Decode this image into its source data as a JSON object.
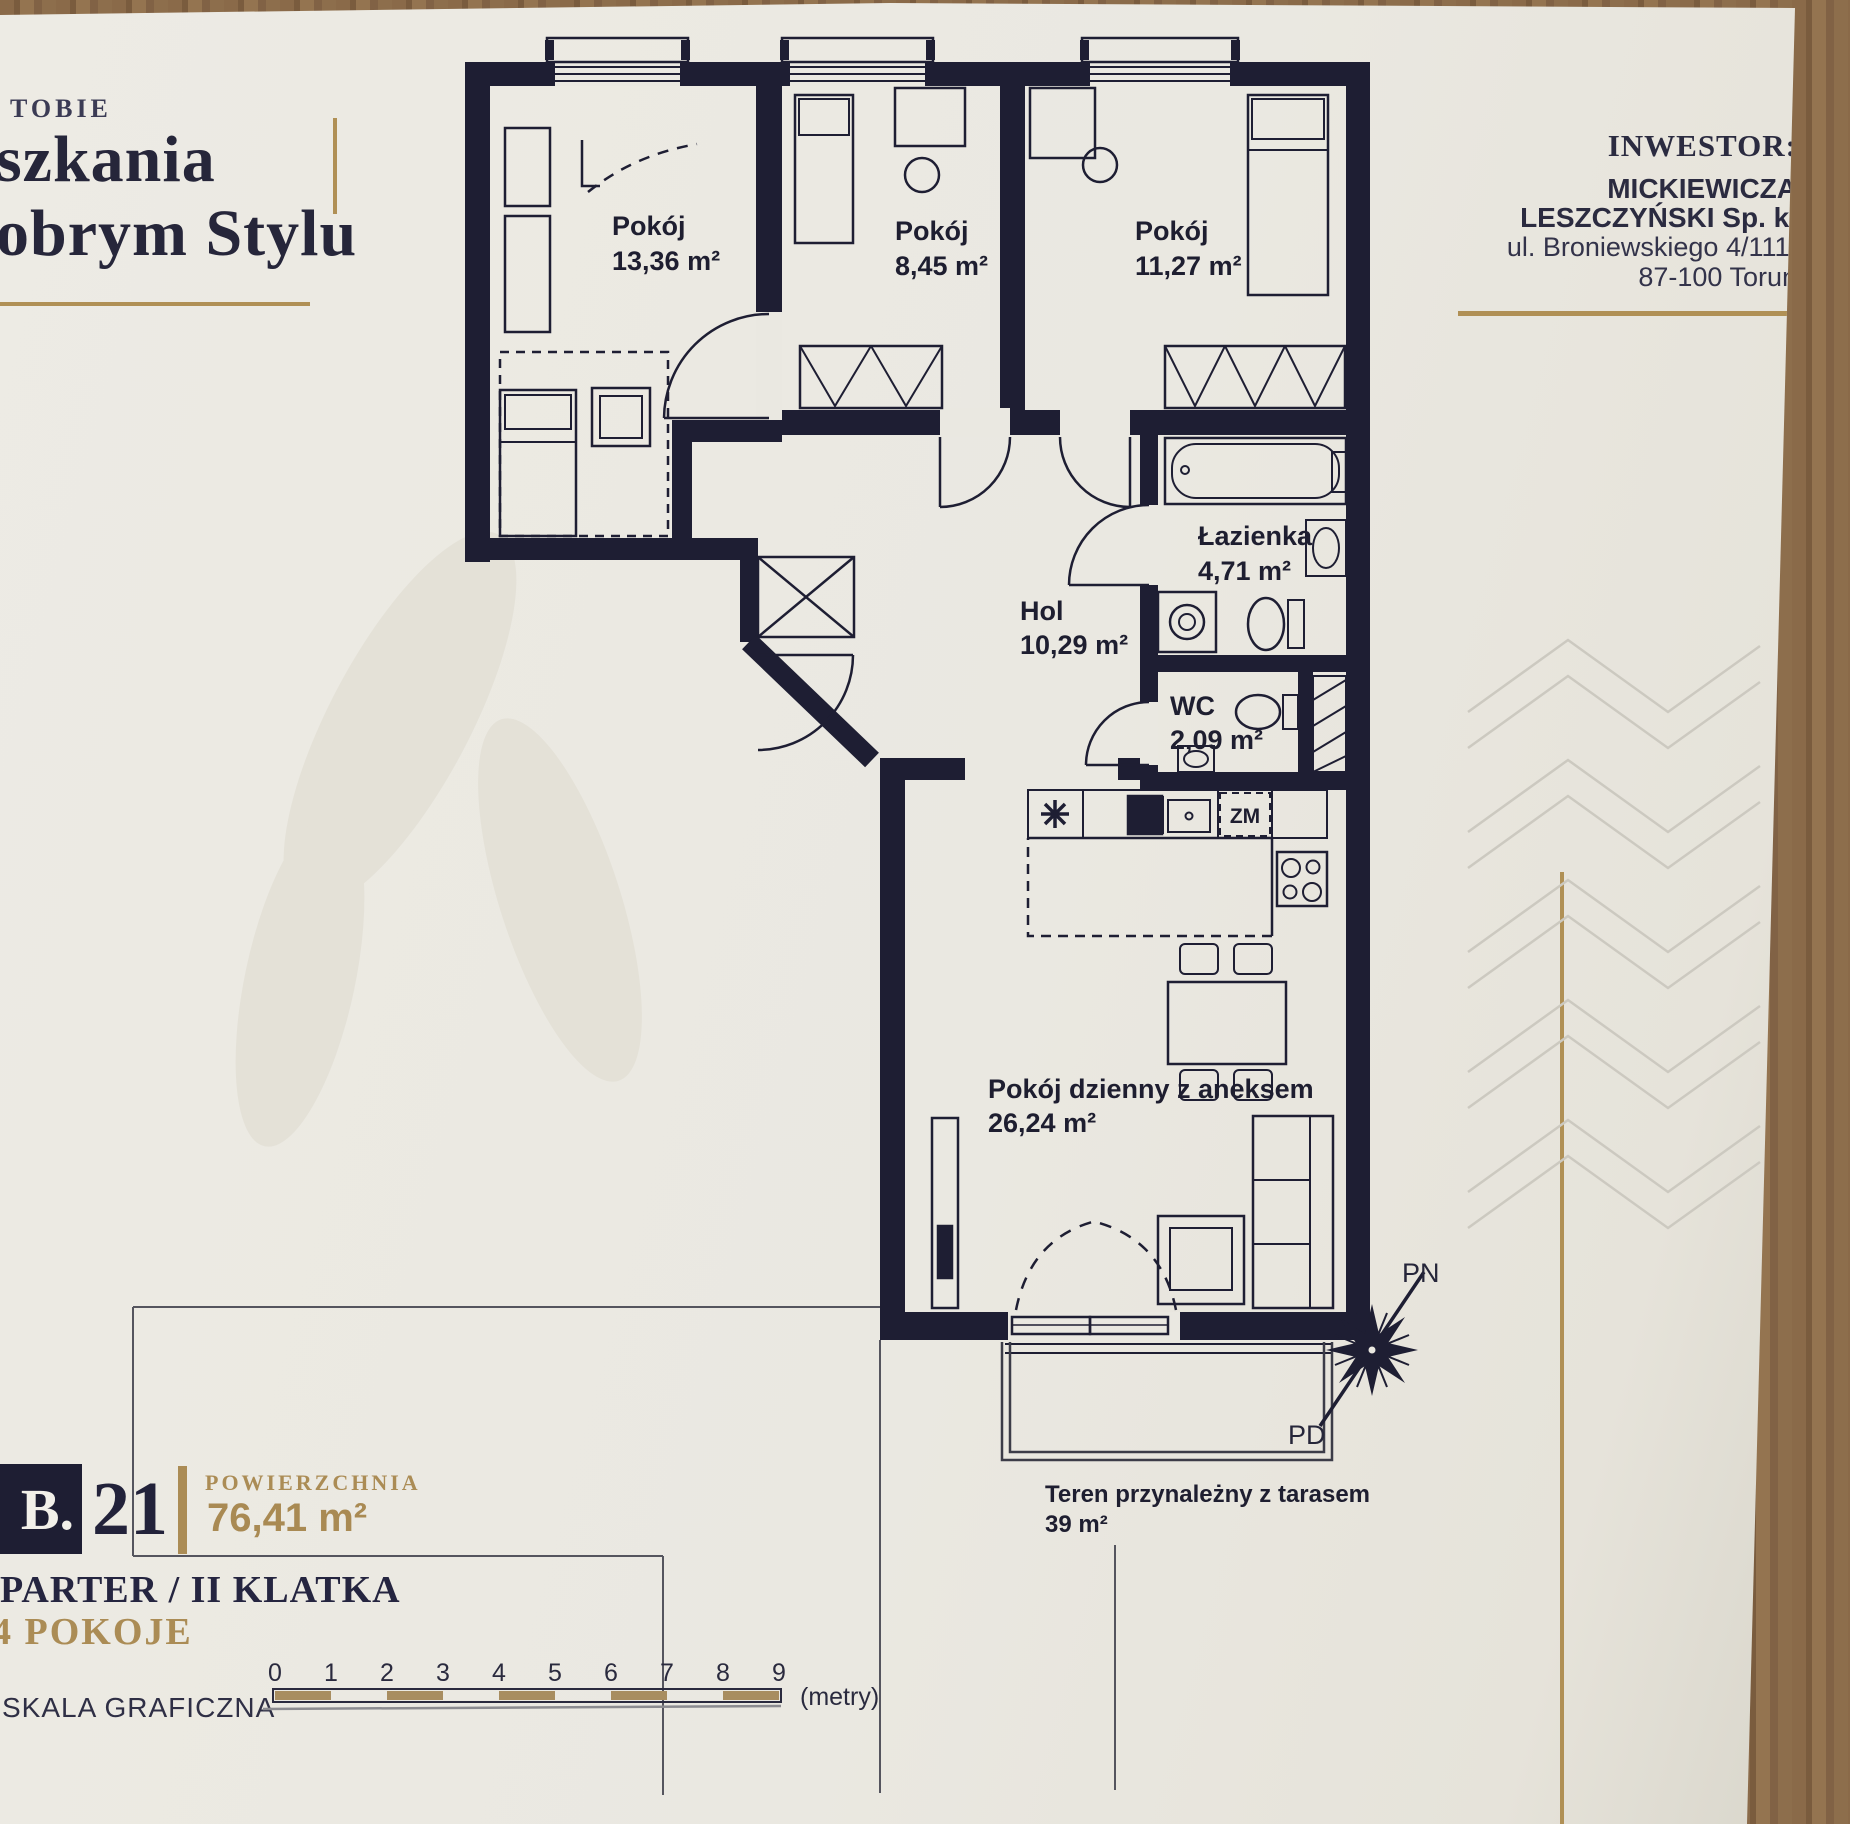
{
  "branding": {
    "tagline": "TOBIE",
    "title_line1": "szkania",
    "title_line2": "obrym Stylu"
  },
  "investor": {
    "heading": "INWESTOR:",
    "name_line1": "MICKIEWICZA",
    "name_line2": "LESZCZYŃSKI Sp. k.",
    "address_line1": "ul. Broniewskiego 4/111,",
    "address_line2": "87-100 Toruń"
  },
  "rooms": [
    {
      "name": "Pokój",
      "area": "13,36 m²"
    },
    {
      "name": "Pokój",
      "area": "8,45 m²"
    },
    {
      "name": "Pokój",
      "area": "11,27 m²"
    },
    {
      "name": "Łazienka",
      "area": "4,71 m²"
    },
    {
      "name": "Hol",
      "area": "10,29 m²"
    },
    {
      "name": "WC",
      "area": "2,09 m²"
    },
    {
      "name": "Pokój dzienny z aneksem",
      "area": "26,24 m²"
    },
    {
      "name": "Teren przynależny z tarasem",
      "area": "39 m²"
    }
  ],
  "kitchen": {
    "dishwasher_label": "ZM"
  },
  "unit": {
    "building_code": "B.",
    "unit_number": "21",
    "area_label": "POWIERZCHNIA",
    "area_value": "76,41 m²",
    "floor_info": "PARTER / II KLATKA",
    "rooms_info": "4 POKOJE"
  },
  "scale_bar": {
    "label": "SKALA GRAFICZNA",
    "ticks": [
      "0",
      "1",
      "2",
      "3",
      "4",
      "5",
      "6",
      "7",
      "8",
      "9"
    ],
    "unit_label": "(metry)"
  },
  "compass": {
    "north_label": "PN",
    "south_label": "PD"
  },
  "colors": {
    "accent_gold": "#ab8c55",
    "plan_navy": "#1e1e33"
  }
}
